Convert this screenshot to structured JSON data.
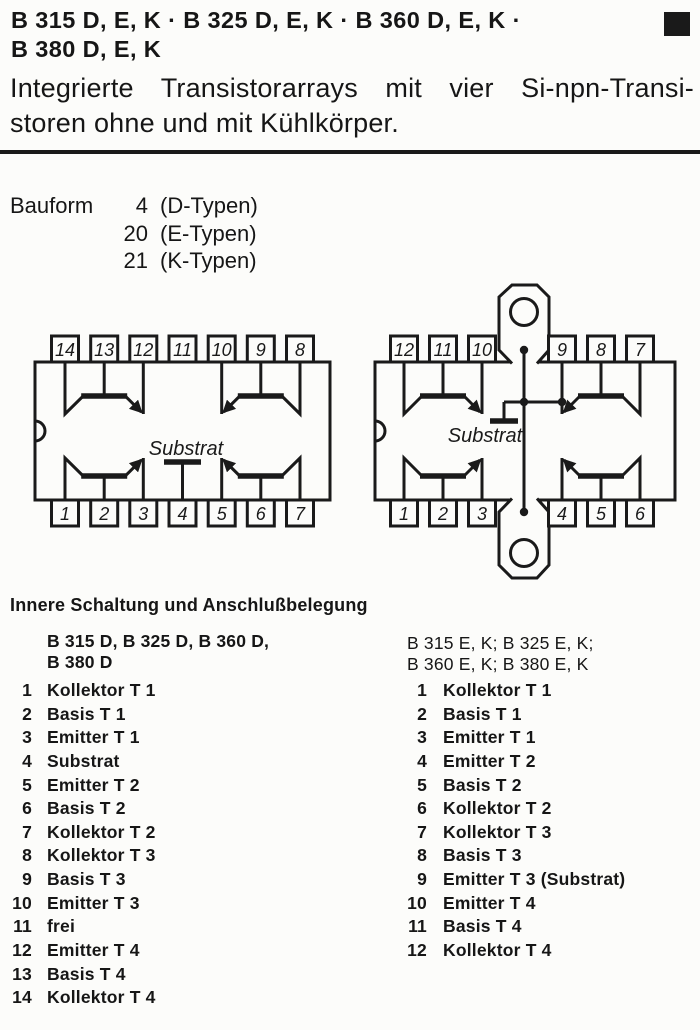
{
  "colors": {
    "ink": "#1a1a1a",
    "paper": "#fcfcfa"
  },
  "header": {
    "title_line1": "B 315 D, E, K · B 325 D, E, K · B 360 D, E, K ·",
    "title_line2": "B 380 D, E, K",
    "subtitle_line1": "Integrierte Transistorarrays mit vier Si-npn-Transi-",
    "subtitle_line2": "storen ohne und mit Kühlkörper."
  },
  "bauform": {
    "label": "Bauform",
    "rows": [
      {
        "num": "4",
        "type": "(D-Typen)"
      },
      {
        "num": "20",
        "type": "(E-Typen)"
      },
      {
        "num": "21",
        "type": "(K-Typen)"
      }
    ]
  },
  "diagrams": {
    "substrate_label": "Substrat",
    "dip14": {
      "top_pins": [
        "14",
        "13",
        "12",
        "11",
        "10",
        "9",
        "8"
      ],
      "bottom_pins": [
        "1",
        "2",
        "3",
        "4",
        "5",
        "6",
        "7"
      ]
    },
    "dip12": {
      "top_pins": [
        "12",
        "11",
        "10",
        "9",
        "8",
        "7"
      ],
      "bottom_pins": [
        "1",
        "2",
        "3",
        "4",
        "5",
        "6"
      ]
    }
  },
  "pinout": {
    "heading": "Innere Schaltung und Anschlußbelegung",
    "left": {
      "header_line1": "B 315 D, B 325 D, B 360 D,",
      "header_line2": "B 380 D",
      "pins": [
        {
          "num": "1",
          "label": "Kollektor T 1"
        },
        {
          "num": "2",
          "label": "Basis T 1"
        },
        {
          "num": "3",
          "label": "Emitter T 1"
        },
        {
          "num": "4",
          "label": "Substrat"
        },
        {
          "num": "5",
          "label": "Emitter T 2"
        },
        {
          "num": "6",
          "label": "Basis T 2"
        },
        {
          "num": "7",
          "label": "Kollektor T 2"
        },
        {
          "num": "8",
          "label": "Kollektor T 3"
        },
        {
          "num": "9",
          "label": "Basis T 3"
        },
        {
          "num": "10",
          "label": "Emitter T 3"
        },
        {
          "num": "11",
          "label": "frei"
        },
        {
          "num": "12",
          "label": "Emitter T 4"
        },
        {
          "num": "13",
          "label": "Basis T 4"
        },
        {
          "num": "14",
          "label": "Kollektor T 4"
        }
      ]
    },
    "right": {
      "header_line1": "B 315 E, K; B 325 E, K;",
      "header_line2": "B 360 E, K; B 380 E, K",
      "pins": [
        {
          "num": "1",
          "label": "Kollektor T 1"
        },
        {
          "num": "2",
          "label": "Basis T 1"
        },
        {
          "num": "3",
          "label": "Emitter T 1"
        },
        {
          "num": "4",
          "label": "Emitter T 2"
        },
        {
          "num": "5",
          "label": "Basis T 2"
        },
        {
          "num": "6",
          "label": "Kollektor T 2"
        },
        {
          "num": "7",
          "label": "Kollektor T 3"
        },
        {
          "num": "8",
          "label": "Basis T 3"
        },
        {
          "num": "9",
          "label": "Emitter T 3 (Substrat)"
        },
        {
          "num": "10",
          "label": "Emitter T 4"
        },
        {
          "num": "11",
          "label": "Basis T 4"
        },
        {
          "num": "12",
          "label": "Kollektor T 4"
        }
      ]
    }
  }
}
